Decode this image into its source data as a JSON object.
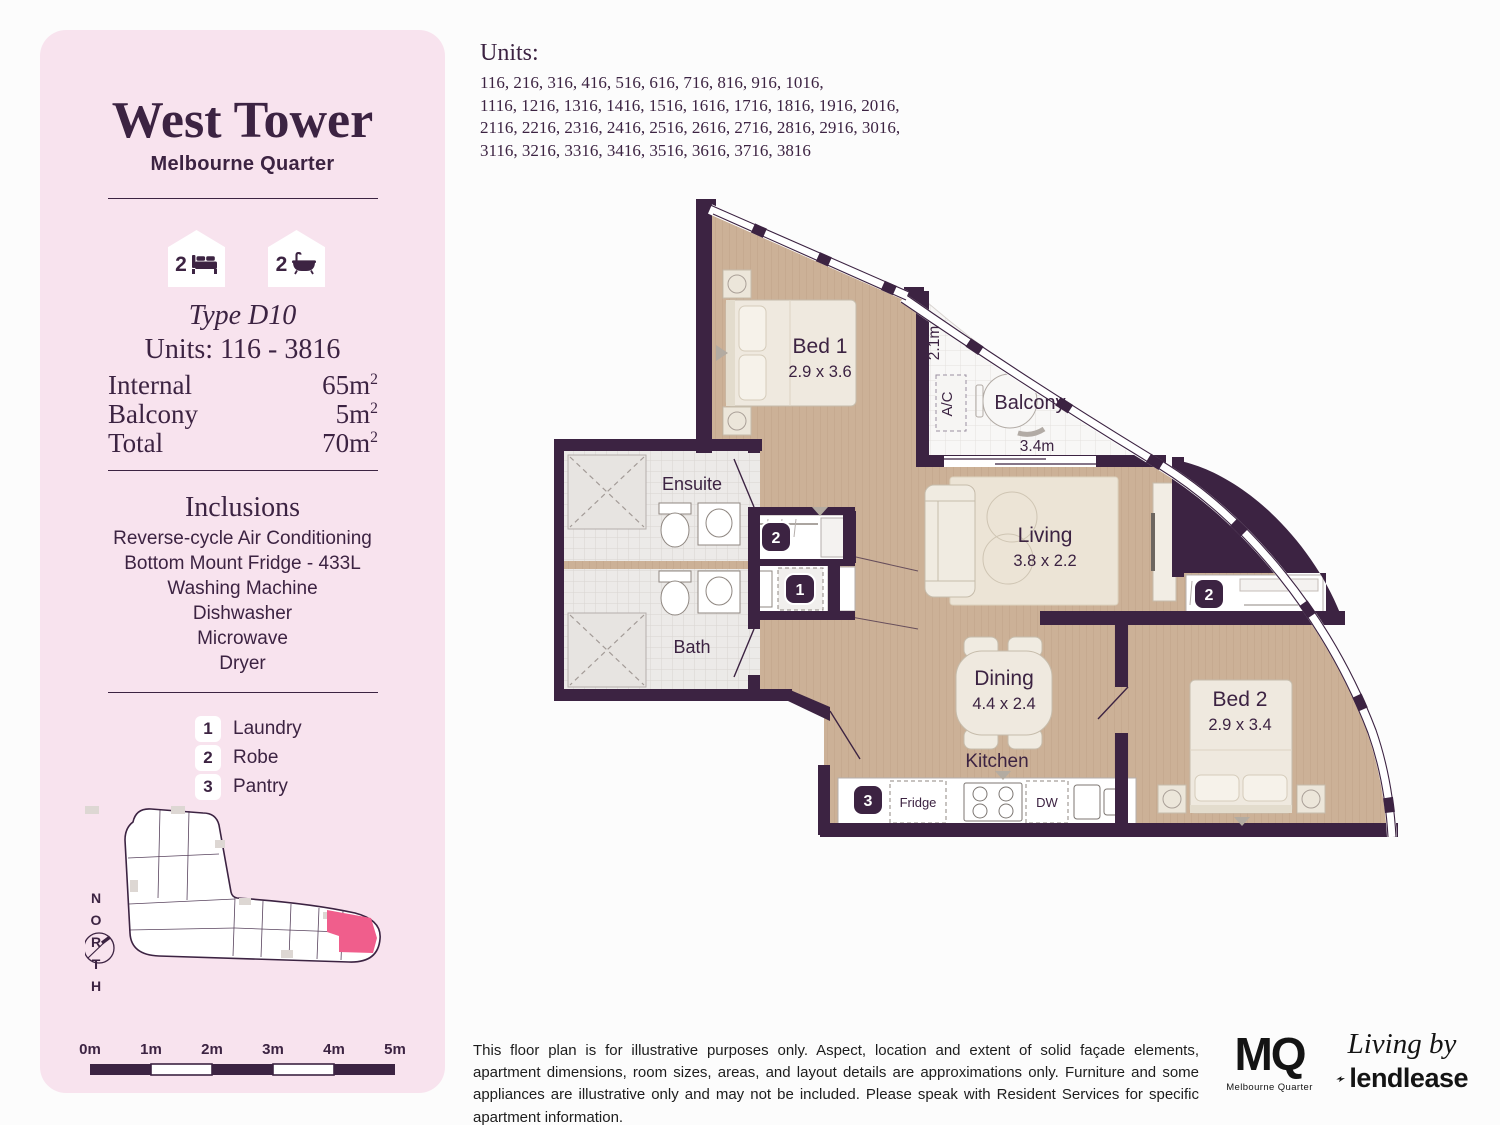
{
  "sidebar": {
    "title": "West Tower",
    "subtitle": "Melbourne Quarter",
    "badges": {
      "bed": {
        "count": "2"
      },
      "bath": {
        "count": "2"
      }
    },
    "type_label": "Type D10",
    "units_range": "Units: 116 - 3816",
    "stats": [
      {
        "label": "Internal",
        "value": "65m",
        "sup": "2"
      },
      {
        "label": "Balcony",
        "value": "5m",
        "sup": "2"
      },
      {
        "label": "Total",
        "value": "70m",
        "sup": "2"
      }
    ],
    "inclusions_title": "Inclusions",
    "inclusions": [
      "Reverse-cycle Air Conditioning",
      "Bottom Mount Fridge - 433L",
      "Washing Machine",
      "Dishwasher",
      "Microwave",
      "Dryer"
    ],
    "legend": [
      {
        "num": "1",
        "label": "Laundry"
      },
      {
        "num": "2",
        "label": "Robe"
      },
      {
        "num": "3",
        "label": "Pantry"
      }
    ],
    "north_label": "NORTH",
    "scale_labels": [
      "0m",
      "1m",
      "2m",
      "3m",
      "4m",
      "5m"
    ]
  },
  "units_list": {
    "heading": "Units:",
    "lines": [
      "116, 216, 316, 416, 516, 616, 716, 816, 916, 1016,",
      "1116, 1216, 1316, 1416, 1516, 1616, 1716, 1816, 1916, 2016,",
      "2116, 2216, 2316, 2416, 2516, 2616, 2716, 2816, 2916, 3016,",
      "3116, 3216, 3316, 3416, 3516, 3616, 3716, 3816"
    ]
  },
  "plan": {
    "rooms": {
      "bed1": {
        "name": "Bed 1",
        "dims": "2.9 x 3.6"
      },
      "bed2": {
        "name": "Bed 2",
        "dims": "2.9 x 3.4"
      },
      "living": {
        "name": "Living",
        "dims": "3.8 x 2.2"
      },
      "dining": {
        "name": "Dining",
        "dims": "4.4 x 2.4"
      },
      "kitchen": {
        "name": "Kitchen"
      },
      "ensuite": {
        "name": "Ensuite"
      },
      "bath": {
        "name": "Bath"
      },
      "balcony": {
        "name": "Balcony"
      }
    },
    "dims": {
      "balcony_width": "3.4m",
      "balcony_depth": "2.1m"
    },
    "labels": {
      "ac": "A/C",
      "fridge": "Fridge",
      "dw": "DW"
    },
    "badges": {
      "laundry": "1",
      "robe": "2",
      "pantry": "3"
    }
  },
  "footer": {
    "disclaimer": "This floor plan is for illustrative purposes only. Aspect, location and extent of solid façade elements, apartment dimensions, room sizes, areas, and layout details are approximations only. Furniture and some appliances are illustrative only and may not be included. Please speak with Resident Services for specific apartment information.",
    "mq": {
      "text": "MQ",
      "sub": "Melbourne Quarter"
    },
    "lendlease": {
      "tagline": "Living by",
      "brand": "lendlease"
    }
  },
  "colors": {
    "panel_pink": "#f8e3ee",
    "purple": "#3c2342",
    "highlight_pink": "#f05e8c",
    "wood": "#ccb197"
  }
}
